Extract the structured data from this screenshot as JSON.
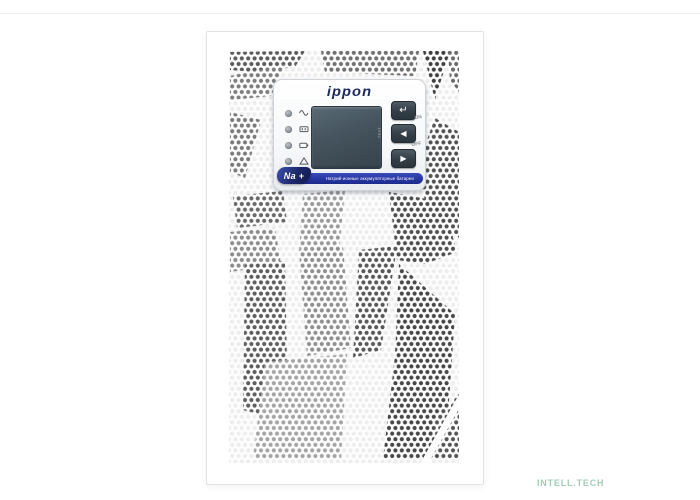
{
  "meta": {
    "background_color": "#ffffff",
    "watermark": {
      "text": "INTELL.TECH",
      "color": "#a3cdb5"
    }
  },
  "device": {
    "kind": "UPS tower front panel product photo",
    "body_color": "#ffffff",
    "grille": {
      "pattern": "hexagonal-perforation",
      "metal_color": "#fdfdfd"
    },
    "control_panel": {
      "logo": "ippon",
      "logo_color": "#1d2a5e",
      "indicators": [
        {
          "id": "ac-normal",
          "icon": "sine-wave-icon"
        },
        {
          "id": "battery",
          "icon": "battery-terminals-icon"
        },
        {
          "id": "bypass",
          "icon": "battery-icon"
        },
        {
          "id": "fault",
          "icon": "warning-triangle-icon"
        }
      ],
      "display": {
        "type": "lcd",
        "color": "#46555f"
      },
      "buttons": [
        {
          "id": "enter",
          "glyph": "↵"
        },
        {
          "id": "scroll-left",
          "glyph": "◀"
        },
        {
          "id": "scroll-right",
          "glyph": "▶"
        }
      ],
      "labels": {
        "test": "TEST",
        "on": "ON",
        "off": "OFF"
      },
      "banner": {
        "badge": "Na +",
        "badge_color": "#111b52",
        "strip_color": "#2534a0",
        "text": "Натрий-ионные аккумуляторные батареи"
      }
    }
  }
}
